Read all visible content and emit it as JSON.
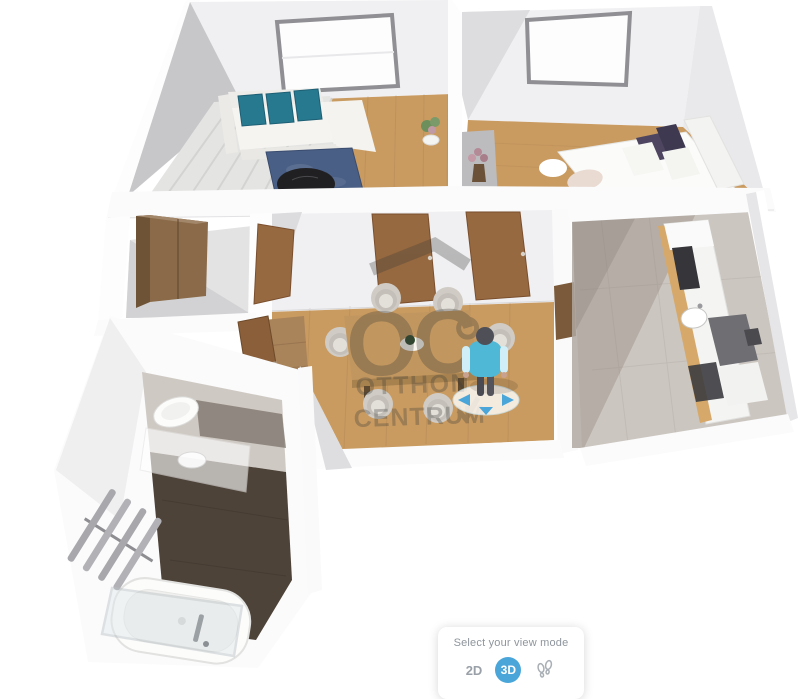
{
  "watermark": {
    "logo": "OC",
    "line1": "OTTHON",
    "line2": "CENTRUM"
  },
  "view_mode_panel": {
    "title": "Select your view mode",
    "options": [
      {
        "label": "2D",
        "selected": false
      },
      {
        "label": "3D",
        "selected": true
      },
      {
        "label": "walk",
        "icon": "footsteps-icon",
        "selected": false
      }
    ]
  },
  "colors": {
    "accent_blue": "#4aa6d9",
    "panel_text": "#8e959c",
    "option_text": "#99a0a7",
    "wall_white": "#fbfbfc",
    "wall_face": "#f0f0f2",
    "wall_shade": "#c7c7c9",
    "floor_wood": "#c99b61",
    "hall_wood": "#a9835a",
    "floor_tile": "#ccc6c0",
    "tile_shadow": "#b0a8a1",
    "bathroom_floor": "#4e4339",
    "rug_blue": "#4a5f85",
    "pillow_teal": "#27798f",
    "door_brown": "#976940",
    "wardrobe_brown": "#8a6a48",
    "sofa_white": "#f5f4f1",
    "chair_beige": "#dcd8d1",
    "table_wood": "#c2975f",
    "counter_wood": "#d6a96a",
    "appliance_dark": "#35353a",
    "avatar_shirt": "#4fb8d6",
    "watermark_gray": "#3a3a38"
  }
}
